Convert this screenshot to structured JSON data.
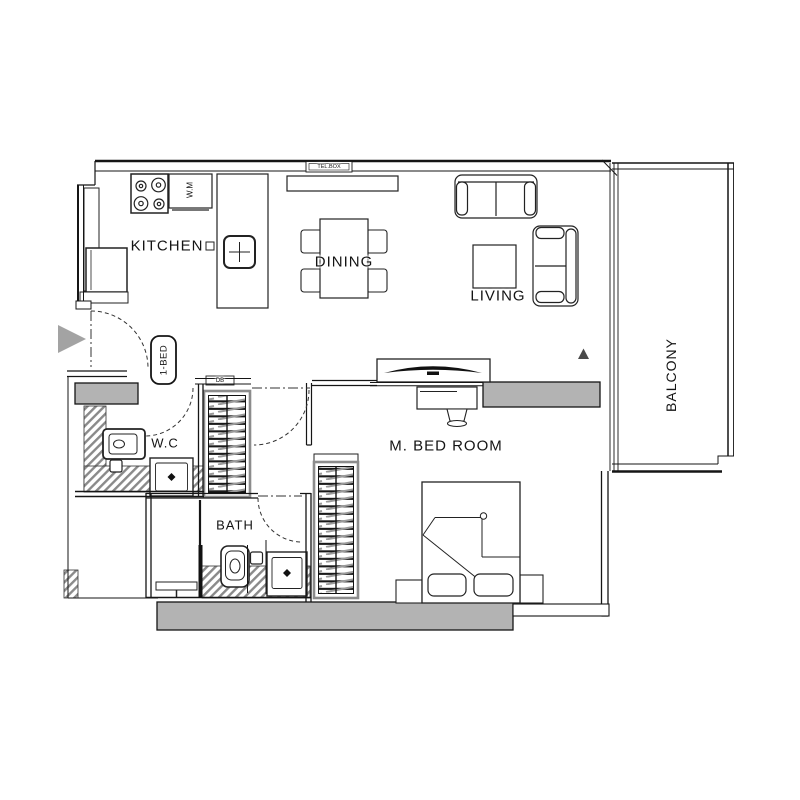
{
  "title": "1-BED apartment floor plan",
  "labels": {
    "kitchen": "KITCHEN",
    "dining": "DINING",
    "living": "LIVING",
    "balcony": "BALCONY",
    "wc": "W.C",
    "bath": "BATH",
    "bedroom": "M. BED ROOM",
    "unit": "1-BED",
    "telbox": "TEL.BOX",
    "db": "DB",
    "wm": "W.M"
  },
  "colors": {
    "wall_gray": "#b3b3b3",
    "line": "#151515",
    "entry_arrow": "#a3a3a3",
    "hatch": "#8a8a8a"
  }
}
